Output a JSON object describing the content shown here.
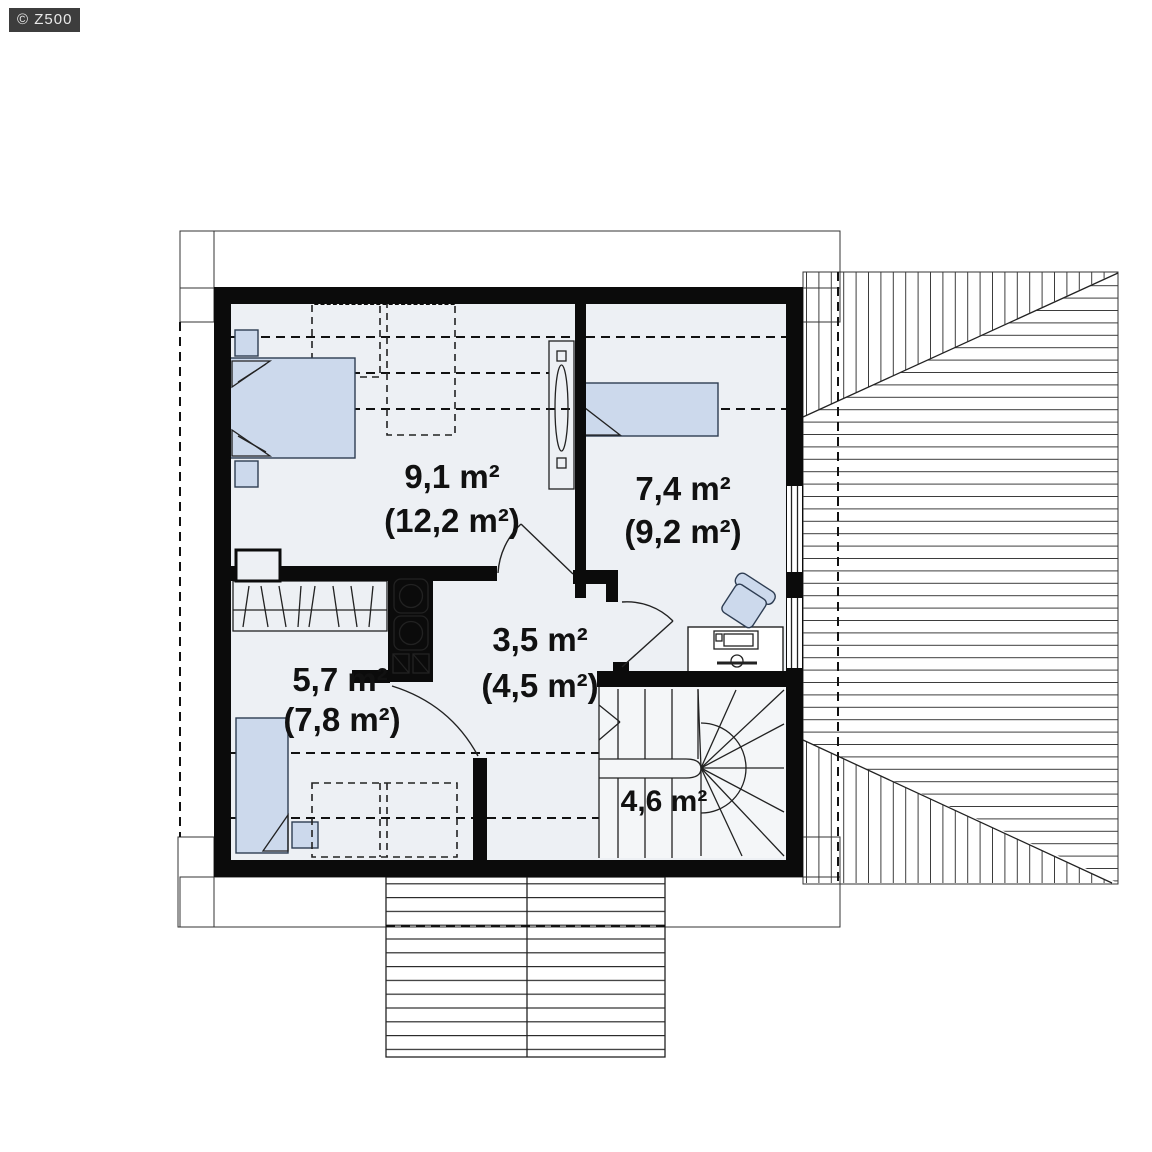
{
  "watermark": {
    "label": "© Z500"
  },
  "rooms": [
    {
      "area": "9,1 m²",
      "area_secondary": "(12,2 m²)"
    },
    {
      "area": "7,4 m²",
      "area_secondary": "(9,2 m²)"
    },
    {
      "area": "3,5 m²",
      "area_secondary": "(4,5 m²)"
    },
    {
      "area": "5,7 m²",
      "area_secondary": "(7,8 m²)"
    },
    {
      "area": "4,6 m²",
      "area_secondary": ""
    }
  ],
  "colors": {
    "wall": "#0b0b0b",
    "floor": "#edf0f4",
    "furniture": "#ccd9ec",
    "line": "#3c3c3c",
    "watermark_bg": "#3d3d3d",
    "watermark_text": "#e9e9e9"
  }
}
